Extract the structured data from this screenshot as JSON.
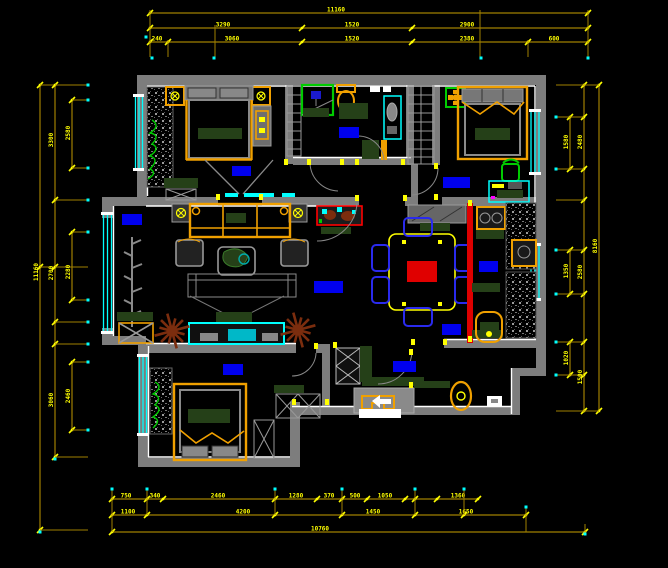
{
  "drawing": {
    "type": "cad-floor-plan",
    "background": "#000000",
    "description": "Apartment furniture floor plan, CAD style on black"
  },
  "colors": {
    "wall": "#7d7d7d",
    "inner_line": "#ffffff",
    "window": "#00ffff",
    "dim_line": "#a07f00",
    "dim_text": "#ffff00",
    "cyan_dot": "#00ffff",
    "furniture_orange": "#f0a000",
    "dark_green": "#254018",
    "label_blue": "#0000ee",
    "accent_red": "#e00000",
    "chair_blue": "#2a2aee",
    "plant_brown": "#7b2d0e",
    "plant_green": "#00cc00"
  },
  "room_labels": [
    {
      "name": "master-bedroom-label",
      "x": 232,
      "y": 166,
      "w": 19,
      "h": 10
    },
    {
      "name": "bathroom-label",
      "x": 339,
      "y": 127,
      "w": 20,
      "h": 11
    },
    {
      "name": "bedroom-top-right-label",
      "x": 443,
      "y": 177,
      "w": 27,
      "h": 11
    },
    {
      "name": "bay-window-label",
      "x": 122,
      "y": 214,
      "w": 20,
      "h": 11
    },
    {
      "name": "living-room-label",
      "x": 314,
      "y": 281,
      "w": 29,
      "h": 12
    },
    {
      "name": "dining-kitchen-label",
      "x": 479,
      "y": 261,
      "w": 19,
      "h": 11
    },
    {
      "name": "kitchen-lower-label",
      "x": 442,
      "y": 324,
      "w": 19,
      "h": 11
    },
    {
      "name": "bedroom-bottom-left-label",
      "x": 223,
      "y": 364,
      "w": 20,
      "h": 11
    },
    {
      "name": "entry-label",
      "x": 393,
      "y": 361,
      "w": 23,
      "h": 11
    }
  ],
  "entry_marker": {
    "arrow_icon": "entry-direction-arrow",
    "label_block": {
      "x": 359,
      "y": 409,
      "w": 42,
      "h": 9,
      "color": "#ffffff"
    }
  },
  "door_jambs": [
    [
      216,
      194
    ],
    [
      259,
      194
    ],
    [
      284,
      159
    ],
    [
      307,
      159
    ],
    [
      340,
      159
    ],
    [
      355,
      159
    ],
    [
      401,
      159
    ],
    [
      355,
      195
    ],
    [
      403,
      195
    ],
    [
      434,
      163
    ],
    [
      434,
      194
    ],
    [
      411,
      339
    ],
    [
      443,
      339
    ],
    [
      468,
      200
    ],
    [
      468,
      336
    ],
    [
      333,
      342
    ],
    [
      409,
      349
    ],
    [
      409,
      382
    ],
    [
      292,
      399
    ],
    [
      325,
      399
    ],
    [
      314,
      343
    ]
  ],
  "dimensions": {
    "top_rows": [
      {
        "y": 13,
        "x1": 150,
        "x2": 588,
        "ticks": [
          150,
          588
        ],
        "labels": [
          {
            "x": 336,
            "t": "11160"
          }
        ]
      },
      {
        "y": 28,
        "x1": 150,
        "x2": 588,
        "ticks": [
          150,
          302,
          412,
          588
        ],
        "labels": [
          {
            "x": 223,
            "t": "3290"
          },
          {
            "x": 352,
            "t": "1520"
          },
          {
            "x": 467,
            "t": "2900"
          }
        ]
      },
      {
        "y": 42,
        "x1": 150,
        "x2": 588,
        "ticks": [
          150,
          168,
          302,
          412,
          528,
          588
        ],
        "labels": [
          {
            "x": 157,
            "t": "240"
          },
          {
            "x": 232,
            "t": "3060"
          },
          {
            "x": 352,
            "t": "1520"
          },
          {
            "x": 467,
            "t": "2380"
          },
          {
            "x": 554,
            "t": "600"
          }
        ]
      }
    ],
    "top_ext": [
      {
        "x": 150,
        "y1": 10,
        "y2": 57
      },
      {
        "x": 168,
        "y1": 40,
        "y2": 57
      },
      {
        "x": 215,
        "y1": 25,
        "y2": 57
      },
      {
        "x": 480,
        "y1": 10,
        "y2": 57
      },
      {
        "x": 528,
        "y1": 40,
        "y2": 57
      },
      {
        "x": 588,
        "y1": 10,
        "y2": 57
      }
    ],
    "left_cols": [
      {
        "x": 40,
        "y1": 85,
        "y2": 530,
        "ticks": [
          85,
          267,
          530
        ],
        "labels": [
          {
            "y": 272,
            "t": "11160"
          }
        ]
      },
      {
        "x": 55,
        "y1": 85,
        "y2": 457,
        "ticks": [
          85,
          200,
          267,
          322,
          344,
          457
        ],
        "labels": [
          {
            "y": 140,
            "t": "3300"
          },
          {
            "y": 273,
            "t": "2700"
          },
          {
            "y": 400,
            "t": "3060"
          }
        ]
      },
      {
        "x": 72,
        "segs": [
          [
            100,
            168
          ],
          [
            232,
            300
          ],
          [
            362,
            430
          ]
        ],
        "labels": [
          {
            "y": 133,
            "t": "2580"
          },
          {
            "y": 272,
            "t": "2280"
          },
          {
            "y": 396,
            "t": "2460"
          }
        ]
      }
    ],
    "left_ext_x2": 88,
    "right_cols": [
      {
        "x": 570,
        "segs": [
          [
            117,
            169
          ],
          [
            250,
            294
          ],
          [
            342,
            375
          ]
        ],
        "labels": [
          {
            "y": 142,
            "t": "1580"
          },
          {
            "y": 271,
            "t": "1350"
          },
          {
            "y": 358,
            "t": "1020"
          }
        ]
      },
      {
        "x": 584,
        "y1": 85,
        "y2": 411,
        "ticks": [
          85,
          117,
          169,
          200,
          250,
          294,
          342,
          375,
          411
        ],
        "labels": [
          {
            "y": 142,
            "t": "2480"
          },
          {
            "y": 272,
            "t": "2580"
          },
          {
            "y": 377,
            "t": "1500"
          }
        ]
      },
      {
        "x": 599,
        "y1": 85,
        "y2": 411,
        "ticks": [
          85,
          411
        ],
        "labels": [
          {
            "y": 246,
            "t": "8160"
          }
        ]
      }
    ],
    "right_ext_x1": 556,
    "bottom_rows": [
      {
        "y": 499,
        "x1": 112,
        "x2": 478,
        "ticks": [
          112,
          147,
          163,
          275,
          317,
          342,
          367,
          405,
          415,
          437,
          478
        ],
        "labels": [
          {
            "x": 126,
            "t": "750"
          },
          {
            "x": 155,
            "t": "340"
          },
          {
            "x": 218,
            "t": "2460"
          },
          {
            "x": 296,
            "t": "1280"
          },
          {
            "x": 329,
            "t": "370"
          },
          {
            "x": 355,
            "t": "500"
          },
          {
            "x": 385,
            "t": "1050"
          },
          {
            "x": 458,
            "t": "1360"
          }
        ]
      },
      {
        "y": 515,
        "x1": 112,
        "x2": 526,
        "ticks": [
          112,
          147,
          275,
          342,
          415,
          464,
          526
        ],
        "labels": [
          {
            "x": 128,
            "t": "1100"
          },
          {
            "x": 243,
            "t": "4200"
          },
          {
            "x": 373,
            "t": "1450"
          },
          {
            "x": 466,
            "t": "1650"
          }
        ]
      },
      {
        "y": 532,
        "x1": 112,
        "x2": 585,
        "ticks": [
          112,
          585
        ],
        "labels": [
          {
            "x": 320,
            "t": "10760"
          }
        ]
      }
    ],
    "bottom_ext": [
      {
        "x": 112,
        "y1": 490,
        "y2": 532
      },
      {
        "x": 147,
        "y1": 490,
        "y2": 515
      },
      {
        "x": 275,
        "y1": 490,
        "y2": 515
      },
      {
        "x": 342,
        "y1": 490,
        "y2": 515
      },
      {
        "x": 415,
        "y1": 490,
        "y2": 515
      },
      {
        "x": 464,
        "y1": 490,
        "y2": 515
      },
      {
        "x": 526,
        "y1": 508,
        "y2": 532
      },
      {
        "x": 585,
        "y1": 524,
        "y2": 535
      }
    ],
    "cyan_dots": [
      [
        146,
        37
      ],
      [
        152,
        58
      ],
      [
        214,
        58
      ],
      [
        481,
        58
      ],
      [
        588,
        58
      ],
      [
        88,
        85
      ],
      [
        88,
        100
      ],
      [
        88,
        168
      ],
      [
        88,
        200
      ],
      [
        88,
        232
      ],
      [
        88,
        300
      ],
      [
        88,
        322
      ],
      [
        88,
        344
      ],
      [
        88,
        362
      ],
      [
        88,
        430
      ],
      [
        556,
        117
      ],
      [
        556,
        169
      ],
      [
        556,
        250
      ],
      [
        556,
        294
      ],
      [
        556,
        342
      ],
      [
        556,
        375
      ],
      [
        112,
        489
      ],
      [
        147,
        489
      ],
      [
        275,
        489
      ],
      [
        342,
        489
      ],
      [
        415,
        489
      ],
      [
        464,
        489
      ],
      [
        526,
        507
      ],
      [
        585,
        534
      ],
      [
        40,
        532
      ],
      [
        55,
        459
      ]
    ]
  },
  "burst_plants": [
    [
      172,
      331
    ],
    [
      298,
      330
    ]
  ],
  "furniture_inventory": [
    "double-bed-master",
    "nightstand-left",
    "nightstand-right",
    "wardrobe-speckled-master",
    "shower-cabin",
    "toilet",
    "wash-basin",
    "hall-shelving",
    "hall-closet-ladder",
    "double-bed-top-right",
    "ceiling-fan-icon",
    "desk",
    "green-chair",
    "sofa-set",
    "coffee-table-with-plant",
    "rug",
    "tv-cabinet",
    "display-cabinet-red",
    "dining-table",
    "dining-chairs-blue",
    "sideboard",
    "kitchen-stove",
    "kitchen-sink",
    "double-bed-bottom-left",
    "wardrobe-x-panels",
    "shoe-cabinet",
    "entry-vase",
    "entry-direction-arrow"
  ]
}
